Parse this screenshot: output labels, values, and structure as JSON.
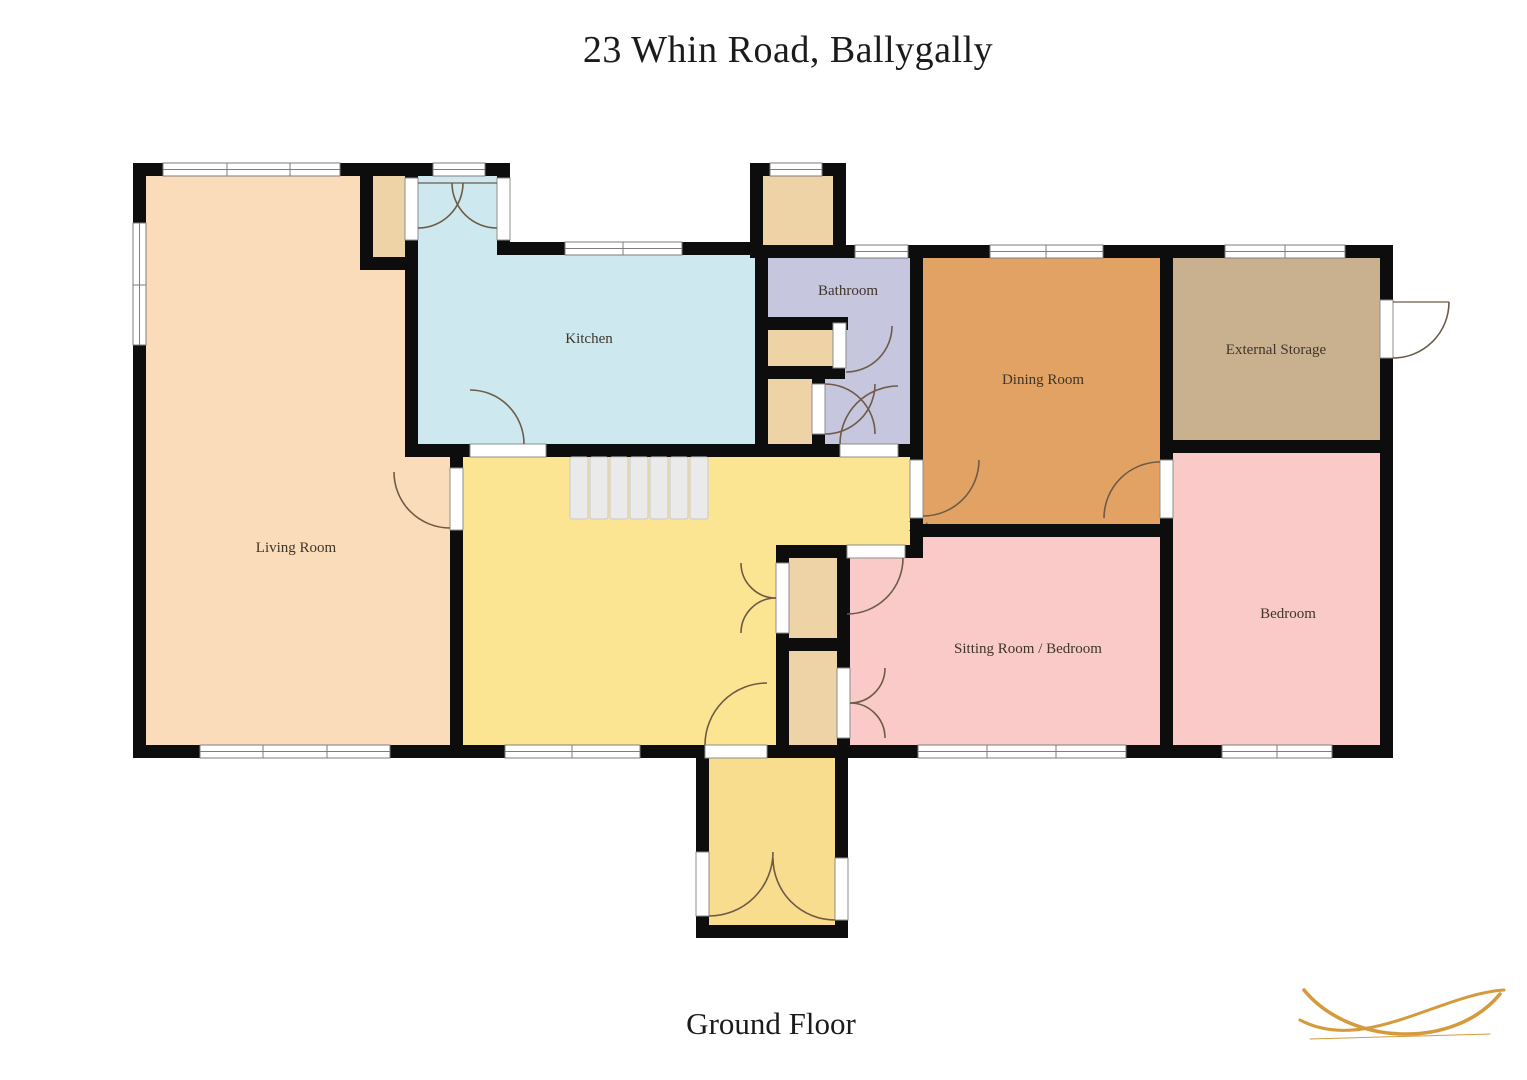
{
  "title": "23 Whin Road, Ballygally",
  "floor": {
    "label": "Ground Floor"
  },
  "rooms": {
    "living_room": {
      "label": "Living Room",
      "color": "#fbdcba"
    },
    "kitchen": {
      "label": "Kitchen",
      "color": "#cde9ef"
    },
    "bathroom": {
      "label": "Bathroom",
      "color": "#c7c6df"
    },
    "dining_room": {
      "label": "Dining Room",
      "color": "#e2a263"
    },
    "external_storage": {
      "label": "External Storage",
      "color": "#c9b190"
    },
    "bedroom": {
      "label": "Bedroom",
      "color": "#f9cac8"
    },
    "sitting_room": {
      "label": "Sitting Room / Bedroom",
      "color": "#f9cac8"
    },
    "hallway": {
      "label": "Entrance",
      "color": "#fbe593"
    },
    "porch": {
      "color": "#f8dd8e"
    },
    "closet_color": "#edd3a6"
  },
  "palette": {
    "wall": "#0d0d0d",
    "window_frame": "#7e7e7e",
    "door_arc": "#6e5b46",
    "stairs_fill": "#eaeaea",
    "stairs_line": "#c9c9c9",
    "label_text": "#3f352a",
    "logo": "#d49a3c"
  }
}
